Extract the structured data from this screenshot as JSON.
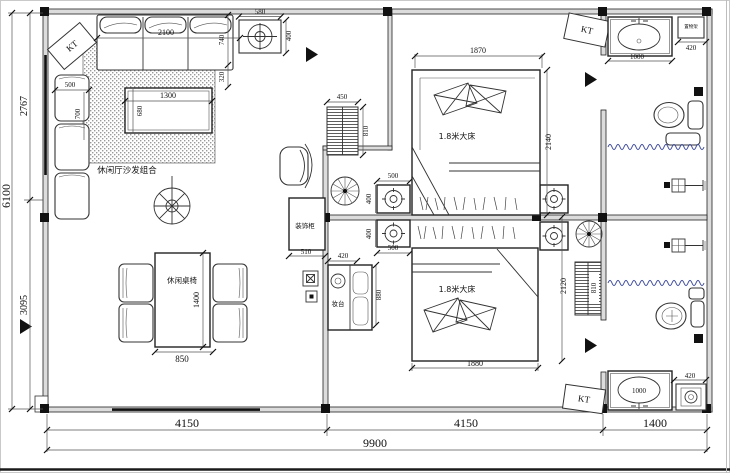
{
  "plan": {
    "labels": {
      "kt": "KT",
      "living_group": "休闲厅沙发组合",
      "dining_set": "休闲桌椅",
      "bed": "1.8米大床",
      "cabinet": "装饰柜",
      "dresser": "妆台",
      "shelf": "置物架"
    },
    "dims": {
      "fixture_w": "580",
      "fixture_h": "400",
      "sofa_w": "2100",
      "sofa_d": "740",
      "sofa_offset": "320",
      "armchair_w": "500",
      "armchair_d": "700",
      "coffee_w": "1300",
      "coffee_d": "680",
      "closet_w": "450",
      "closet_h": "810",
      "ns_w": "500",
      "ns_d": "400",
      "ns2_d": "400",
      "ns2_w": "500",
      "bed1_w": "1870",
      "bed1_l": "2140",
      "bed2_w": "1880",
      "bed2_l": "2120",
      "cabinet_w": "510",
      "dresser_w": "420",
      "dresser_l": "880",
      "radiator2_h": "810",
      "dining_w": "850",
      "dining_l": "1400",
      "vanity1_w": "1000",
      "shelf1_w": "420",
      "vanity2_w": "1000",
      "shelf2_w": "420",
      "bottom_seg1": "4150",
      "bottom_seg2": "4150",
      "bottom_seg3": "1400",
      "bottom_total": "9900",
      "left_top": "2767",
      "left_bottom": "3095",
      "left_total": "6100"
    }
  }
}
